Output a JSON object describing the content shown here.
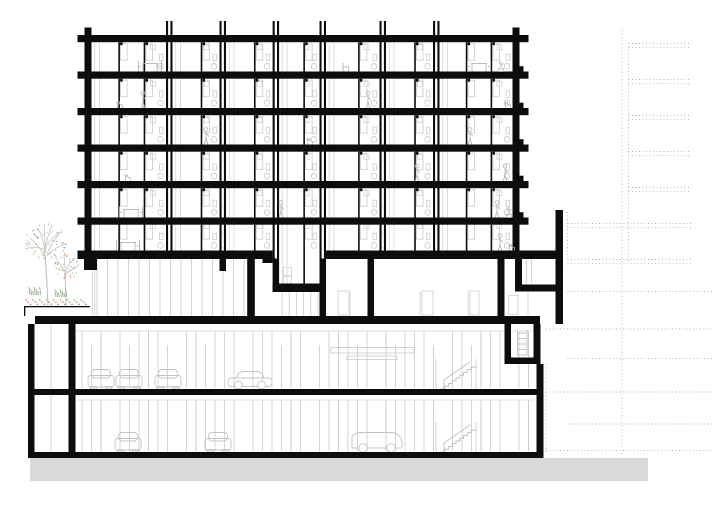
{
  "meta": {
    "label": "Architectural building cross-section drawing",
    "drawing_type": "section"
  },
  "palette": {
    "ink": "#0d0d0d",
    "line": "#d0d0d0",
    "line_soft": "#e2e2e2",
    "figure": "#b5b5b5",
    "car": "#c3c3c3",
    "stair": "#c0c0c0",
    "ground": "#d9d9d9",
    "dotted": "#ababab",
    "branch": "#bfc3bf",
    "canopy": [
      "#cfd4cf",
      "#d98b8b",
      "#8e9fd4",
      "#9ec29e",
      "#e0b36a"
    ],
    "canopy2": [
      "#b9c9b4",
      "#d98b8b",
      "#e0a36a",
      "#cfd4cf"
    ],
    "flowers": [
      "#d98b8b",
      "#e0a36a",
      "#b97fb0",
      "#9ec29e",
      "#d98b8b",
      "#8aa882"
    ],
    "grass": "#8fa98a"
  },
  "canvas": {
    "w": 715,
    "h": 506
  },
  "tower": {
    "left_wall": [
      84.5,
      27.5,
      7,
      231.5
    ],
    "right_wall": [
      512.5,
      27.5,
      7,
      231.5
    ],
    "slab_x": 84,
    "slab_w": 439,
    "slab_h": 7.2,
    "slabs_y": [
      35,
      71.5,
      108,
      144.5,
      181,
      217.5
    ],
    "bottom_y": 250.5,
    "bottom_h": 8.5,
    "pair_x": [
      166,
      219.5,
      272.6,
      319.5,
      379.5,
      433
    ],
    "pair_top": 21,
    "pair_bottom": 258.5,
    "pair_line_w": 2.1,
    "pair_gap": 4.4,
    "bays": [
      [
        91.5,
        166
      ],
      [
        172.5,
        219.5
      ],
      [
        226,
        272.6
      ],
      [
        279.1,
        319.5
      ],
      [
        326,
        379.5
      ],
      [
        386,
        433
      ],
      [
        439.5,
        512.5
      ]
    ],
    "wide_bays": [
      0,
      6
    ],
    "rooms_bottom": [
      71.5,
      108,
      144.5,
      181,
      217.5,
      250.5
    ],
    "room_h": 29.3,
    "dropped_bay": {
      "bay": 3,
      "row": 5,
      "bottom": 283.5
    }
  },
  "ink_rects": [
    [
      219.5,
      258.5,
      6.5,
      12.5
    ],
    [
      272.6,
      258.5,
      6.5,
      33.5
    ],
    [
      319.5,
      258.5,
      6.5,
      58.5
    ],
    [
      84,
      250.5,
      188.6,
      8.5
    ],
    [
      325.5,
      250.5,
      230,
      8.5
    ],
    [
      84,
      250.5,
      13,
      19.5
    ],
    [
      262.5,
      258.5,
      10.1,
      4.5
    ],
    [
      247.2,
      258.5,
      7.6,
      58
    ],
    [
      272.6,
      283.5,
      47,
      8.5
    ],
    [
      367.5,
      258.5,
      6.5,
      58
    ],
    [
      497.5,
      258.5,
      7,
      58
    ],
    [
      515,
      258.5,
      7,
      26
    ],
    [
      515,
      284.5,
      48,
      7
    ],
    [
      555.5,
      210,
      7.5,
      114
    ],
    [
      35,
      316,
      505,
      8
    ],
    [
      504.5,
      324,
      6.5,
      40
    ],
    [
      533.5,
      324,
      7,
      40
    ],
    [
      504.5,
      357.5,
      36,
      6.5
    ],
    [
      536.5,
      364,
      7,
      94
    ],
    [
      28,
      324,
      6.5,
      134
    ],
    [
      68.5,
      324,
      7,
      134
    ],
    [
      34.5,
      389,
      509,
      6
    ],
    [
      28,
      452,
      515.5,
      6
    ],
    [
      24,
      306,
      66,
      1.3
    ],
    [
      24,
      306,
      1.3,
      10
    ]
  ],
  "podium_gray": {
    "mullion_runs": [
      {
        "x0": 97,
        "x1": 244,
        "step": 10.5,
        "y0": 259,
        "y1": 315.5
      },
      {
        "x0": 282,
        "x1": 318,
        "step": 7.2,
        "y0": 292.5,
        "y1": 315.5
      }
    ],
    "vlines": [
      [
        92.3,
        259,
        315.5
      ],
      [
        94.8,
        259,
        315.5
      ],
      [
        350,
        292,
        315.5
      ],
      [
        420,
        292,
        315.5
      ],
      [
        470,
        292,
        315.5
      ],
      [
        526.5,
        259,
        283.5
      ],
      [
        531.5,
        259,
        283.5
      ],
      [
        528,
        292,
        315
      ],
      [
        51,
        325,
        451
      ]
    ],
    "rects": [
      [
        338,
        291,
        11,
        24
      ],
      [
        422,
        291,
        11,
        24
      ],
      [
        468,
        291,
        11,
        24
      ],
      [
        283.5,
        267.5,
        8,
        8.2
      ],
      [
        283.5,
        276.5,
        8,
        7
      ],
      [
        508.5,
        295.5,
        9.5,
        19
      ]
    ],
    "ladder": {
      "x0": 517.5,
      "x1": 527,
      "y0": 330,
      "y1": 356,
      "rungs": 5
    }
  },
  "basement": {
    "col_x0": 82,
    "col_x1": 532,
    "col_step": 9.5,
    "p1": {
      "y0": 331,
      "y1": 388
    },
    "p2": {
      "y0": 400,
      "y1": 451
    },
    "hlines": [
      [
        76,
        331,
        535
      ],
      [
        76,
        400,
        535
      ]
    ],
    "duct_rects": [
      [
        331,
        347.5,
        83,
        5.5
      ],
      [
        347,
        356,
        50,
        3.5
      ]
    ]
  },
  "cars": [
    {
      "type": "front",
      "x": 101,
      "y": 389
    },
    {
      "type": "front",
      "x": 129,
      "y": 389
    },
    {
      "type": "front",
      "x": 168,
      "y": 389
    },
    {
      "type": "side",
      "x": 228,
      "y": 389
    },
    {
      "type": "front",
      "x": 128,
      "y": 452
    },
    {
      "type": "front",
      "x": 218,
      "y": 452
    },
    {
      "type": "van",
      "x": 352,
      "y": 452
    }
  ],
  "stairs": [
    {
      "x": 441,
      "y": 389
    },
    {
      "x": 441,
      "y": 452
    }
  ],
  "figures": [
    {
      "row": 0,
      "x": 150,
      "t": "table"
    },
    {
      "row": 0,
      "x": 345,
      "t": "chair"
    },
    {
      "row": 0,
      "x": 479,
      "t": "table"
    },
    {
      "row": 0,
      "x": 501,
      "t": "plant"
    },
    {
      "row": 1,
      "x": 120,
      "t": "cat"
    },
    {
      "row": 1,
      "x": 143,
      "t": "person"
    },
    {
      "row": 1,
      "x": 368,
      "t": "person"
    },
    {
      "row": 1,
      "x": 508,
      "t": "cat"
    },
    {
      "row": 2,
      "x": 206,
      "t": "person"
    },
    {
      "row": 2,
      "x": 310,
      "t": "cat"
    },
    {
      "row": 2,
      "x": 470,
      "t": "person"
    },
    {
      "row": 3,
      "x": 128,
      "t": "cat"
    },
    {
      "row": 3,
      "x": 417,
      "t": "person"
    },
    {
      "row": 3,
      "x": 505,
      "t": "person"
    },
    {
      "row": 4,
      "x": 131,
      "t": "table"
    },
    {
      "row": 4,
      "x": 281,
      "t": "person"
    },
    {
      "row": 4,
      "x": 497,
      "t": "person"
    },
    {
      "row": 4,
      "x": 509,
      "t": "plant"
    },
    {
      "row": 5,
      "x": 128,
      "t": "table"
    },
    {
      "row": 5,
      "x": 500,
      "t": "person"
    },
    {
      "row": 5,
      "x": 512,
      "t": "cat"
    }
  ],
  "tree": {
    "trunk1": "M48,306 C47,284 46,262 44,244",
    "branches1": [
      [
        46,
        258,
        30,
        238
      ],
      [
        46,
        252,
        38,
        228
      ],
      [
        45,
        248,
        52,
        226
      ],
      [
        46,
        246,
        62,
        232
      ],
      [
        47,
        256,
        66,
        244
      ],
      [
        45,
        244,
        44,
        224
      ],
      [
        46,
        250,
        25,
        249
      ],
      [
        47,
        254,
        58,
        236
      ]
    ],
    "canopy1": {
      "cx": 47,
      "cy": 243,
      "rx": 22,
      "ry": 19,
      "n": 70
    },
    "trunk2": "M66,306 L65,270",
    "branches2": [
      [
        65,
        272,
        56,
        258
      ],
      [
        65,
        268,
        64,
        254
      ],
      [
        65,
        270,
        74,
        258
      ],
      [
        65,
        274,
        78,
        266
      ]
    ],
    "canopy2": {
      "cx": 67,
      "cy": 266,
      "rx": 13,
      "ry": 13,
      "n": 40
    },
    "flower_row": {
      "x0": 26,
      "x1": 86,
      "y": 300
    },
    "grass_clusters": [
      {
        "x": 30,
        "y": 295
      },
      {
        "x": 56,
        "y": 297
      }
    ]
  },
  "dotted_lines": [
    [
      622,
      30,
      622,
      456
    ],
    [
      628.5,
      43,
      628.5,
      263
    ],
    [
      567.5,
      212,
      567.5,
      258
    ],
    [
      546,
      364,
      546,
      452
    ],
    [
      628.5,
      43.5,
      691,
      43.5
    ],
    [
      628.5,
      47.7,
      691,
      47.7
    ],
    [
      628.5,
      79.5,
      691,
      79.5
    ],
    [
      628.5,
      83.7,
      691,
      83.7
    ],
    [
      628.5,
      115.5,
      691,
      115.5
    ],
    [
      628.5,
      119.7,
      691,
      119.7
    ],
    [
      628.5,
      151.5,
      691,
      151.5
    ],
    [
      628.5,
      155.7,
      691,
      155.7
    ],
    [
      628.5,
      187.5,
      691,
      187.5
    ],
    [
      628.5,
      191.7,
      691,
      191.7
    ],
    [
      567.5,
      223.5,
      691,
      223.5
    ],
    [
      567.5,
      227.7,
      691,
      227.7
    ],
    [
      567.5,
      259.5,
      691,
      259.5
    ],
    [
      567.5,
      263.7,
      691,
      263.7
    ],
    [
      567.5,
      291.5,
      712,
      291.5
    ],
    [
      546,
      329,
      712,
      329
    ],
    [
      567.5,
      358.5,
      712,
      358.5
    ],
    [
      546,
      392,
      712,
      392
    ],
    [
      567.5,
      424,
      712,
      424
    ],
    [
      546,
      450.5,
      712,
      450.5
    ]
  ],
  "ground_strip": [
    30,
    458,
    618,
    23
  ]
}
